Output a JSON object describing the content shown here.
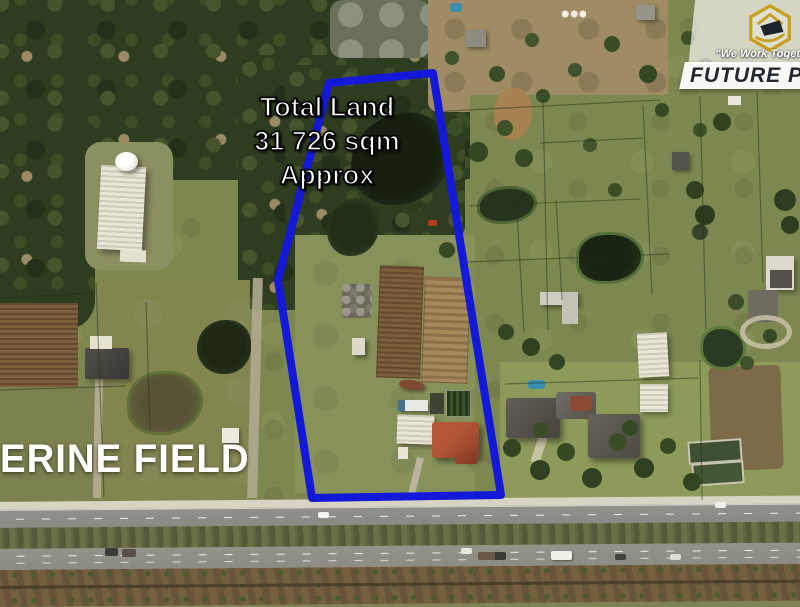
{
  "overlay": {
    "land_area": {
      "lines": [
        "Total Land",
        "31 726 sqm",
        "Approx"
      ],
      "text_color": "#ffffff",
      "outline_color": "#000000"
    },
    "suburb": "ERINE FIELD"
  },
  "logo": {
    "tagline": "“We Work Toget",
    "brand": "FUTURE PAR",
    "hexagon_color": "#C89E1E",
    "brand_color": "#23262F",
    "card_color": "#ffffff"
  },
  "boundary": {
    "color": "#1418D8",
    "stroke_width": "8",
    "points": "329,83 433,73 501,495 312,498 278,280"
  }
}
